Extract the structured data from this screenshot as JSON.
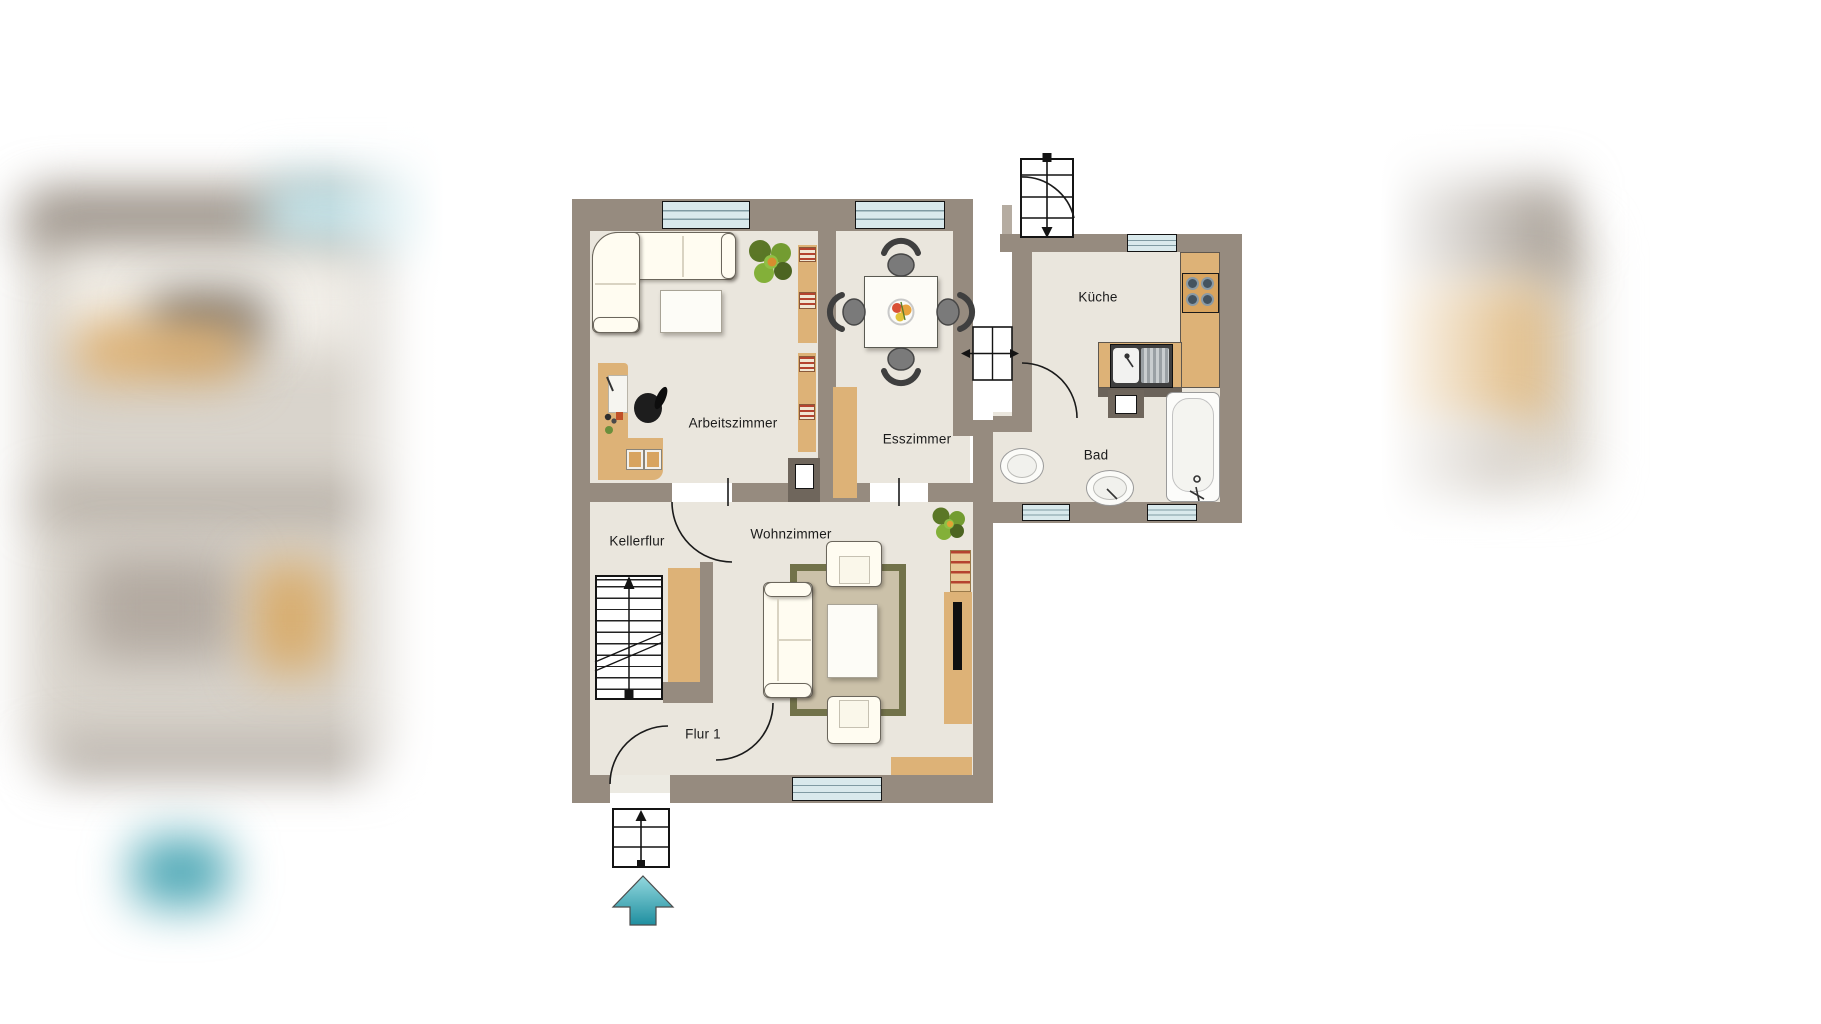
{
  "plan": {
    "kind": "apartment-floor-plan",
    "language": "de",
    "entry_direction": "up"
  },
  "rooms": [
    {
      "id": "arbeitszimmer",
      "label": "Arbeitszimmer",
      "furniture": [
        "corner-sofa-icon",
        "coffee-table-icon",
        "plant-icon",
        "bookshelf-icon",
        "desk-icon",
        "office-chair-icon",
        "visitor-chairs-icon"
      ]
    },
    {
      "id": "esszimmer",
      "label": "Esszimmer",
      "furniture": [
        "dining-table-icon",
        "dining-chair-icon",
        "fruit-bowl-icon",
        "sideboard-icon"
      ]
    },
    {
      "id": "kueche",
      "label": "Küche",
      "furniture": [
        "kitchen-counter-icon",
        "stove-icon",
        "sink-icon"
      ]
    },
    {
      "id": "bad",
      "label": "Bad",
      "furniture": [
        "toilet-icon",
        "washbasin-icon",
        "bathtub-icon"
      ]
    },
    {
      "id": "kellerflur",
      "label": "Kellerflur",
      "furniture": [
        "basement-stairs-icon",
        "wardrobe-icon"
      ]
    },
    {
      "id": "wohnzimmer",
      "label": "Wohnzimmer",
      "furniture": [
        "sofa-icon",
        "armchair-icon",
        "rug-icon",
        "coffee-table-icon",
        "tv-board-icon",
        "radiator-icon",
        "plant-icon",
        "lowboard-icon"
      ]
    },
    {
      "id": "flur1",
      "label": "Flur 1",
      "furniture": [
        "entrance-door-icon"
      ]
    }
  ],
  "symbols": [
    "entry-arrow-up-icon",
    "outdoor-stairs-icon",
    "chimney-shaft-icon",
    "window-icon",
    "door-swing-icon"
  ],
  "colors": {
    "wall": "#968b7f",
    "floor": "#eae6dd",
    "window_glass": "#d9e9ec",
    "wood": "#ddb277",
    "rug_border": "#72724a",
    "radiator_red": "#b5432f",
    "entry_arrow_teal": "#2f93a3",
    "background": "#ffffff"
  }
}
